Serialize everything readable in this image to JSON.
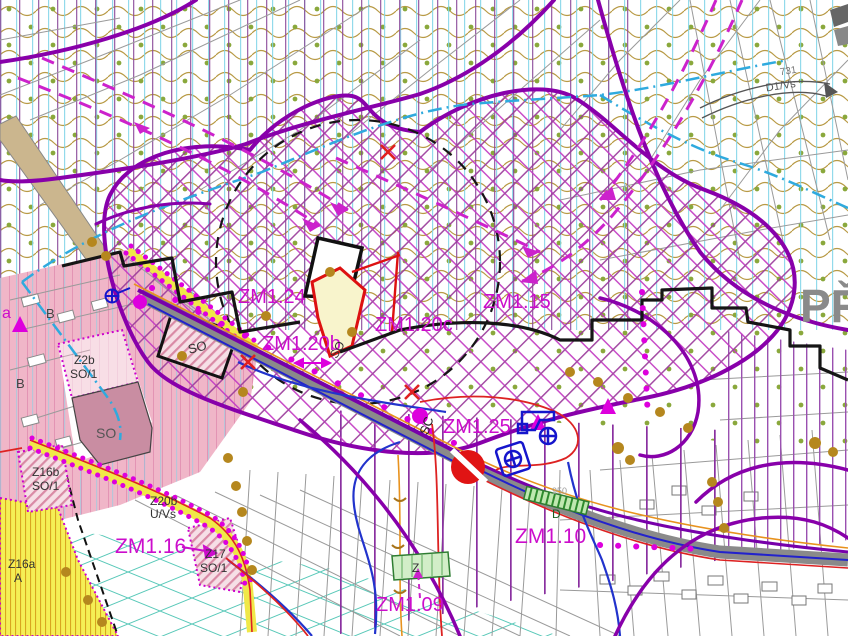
{
  "map": {
    "title": "zoning-plan-detail",
    "change_labels": {
      "zm124": "ZM1.24",
      "zm115": "ZM1.15",
      "zm120c": "ZM1.20c",
      "zm120b": "ZM1.20b",
      "zm125": "ZM1.25",
      "zm116": "ZM1.16",
      "zm110": "ZM1.10",
      "zm109": "ZM1.09"
    },
    "zone_labels": {
      "z2b": "Z2b",
      "z2b_code": "SO/1",
      "z16b": "Z16b",
      "z16b_code": "SO/1",
      "z20b": "Z20b",
      "z20b_code": "U/Vs",
      "z17": "Z17",
      "z17_code": "SO/1",
      "z16a": "Z16a",
      "z16a_code": "A",
      "b_upper": "B",
      "b_lower": "B",
      "so_block": "SO",
      "so_wedge": "SO",
      "so_area": "SO",
      "sc": "SC",
      "z_small": "Z",
      "d_bar": "D",
      "d_bar_num": "950",
      "road_num": "731",
      "road_code": "D1/Vs",
      "a_edge": "a"
    },
    "place_label": "PŘ",
    "colors": {
      "label_magenta": "#cc0dcc",
      "boundary_purple": "#8800aa",
      "crosshatch_magenta": "#c23ac2",
      "road_gray": "#8a8a8a",
      "road_blue": "#2222cc",
      "road_red": "#dd2222",
      "road_orange": "#e8921e",
      "water_cyan": "#2faade",
      "orchard_tan": "#b89a45",
      "dot_green": "#8aa83c",
      "dot_brown": "#b5871e",
      "pink_residential": "#f0b6c8",
      "yellow_zone": "#f5ef55",
      "place_gray": "#8a8a8a"
    }
  }
}
